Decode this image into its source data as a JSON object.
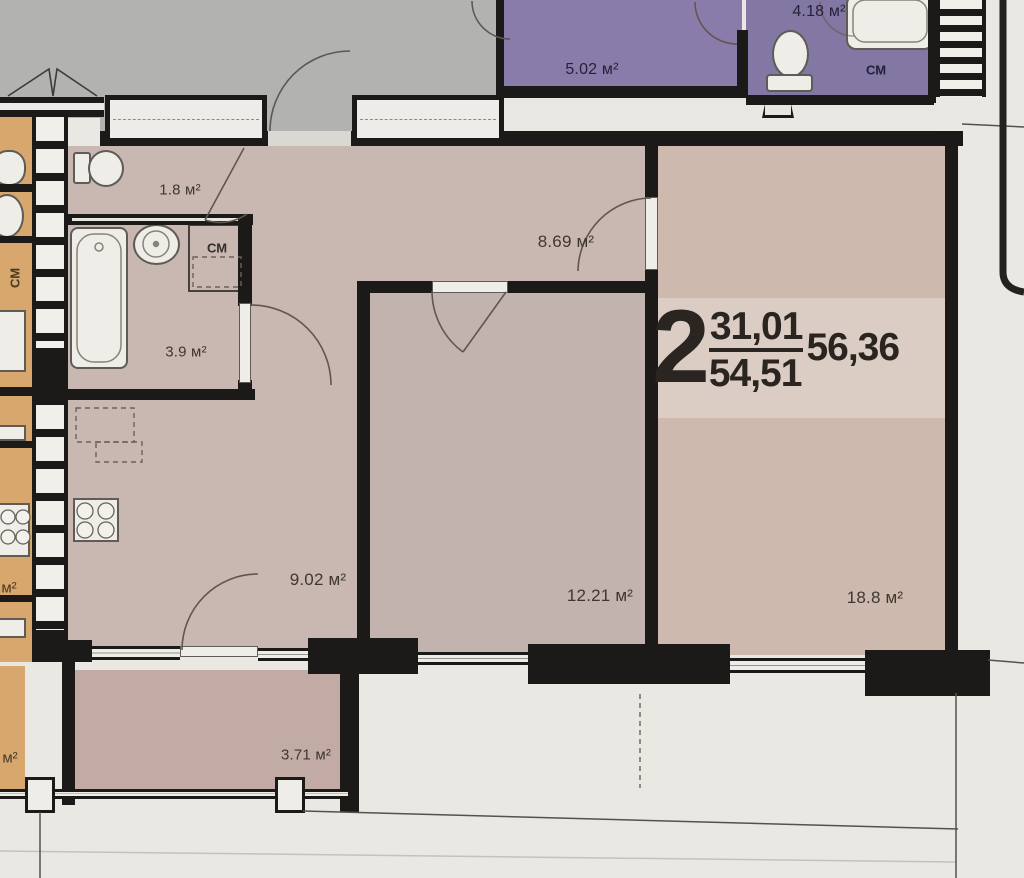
{
  "title": "Apartment floor plan — 2-room flat",
  "stamp": {
    "rooms_count": "2",
    "living_area": "31,01",
    "total_area": "54,51",
    "overall_area": "56,36"
  },
  "rooms": {
    "r502": {
      "label": "5.02 м²"
    },
    "r418": {
      "label": "4.18 м²"
    },
    "top_washer": {
      "label": "СМ"
    },
    "r18": {
      "label": "1.8 м²"
    },
    "washer": {
      "label": "СМ"
    },
    "r39": {
      "label": "3.9 м²"
    },
    "hallway": {
      "label": "8.69 м²"
    },
    "kitchen": {
      "label": "9.02 м²"
    },
    "bedroom": {
      "label": "12.21 м²"
    },
    "living": {
      "label": "18.8 м²"
    },
    "balcony": {
      "label": "3.71 м²"
    },
    "neighbor_washer": {
      "label": "СМ"
    },
    "neighbor_area_1": {
      "label": "м²"
    },
    "neighbor_area_2": {
      "label": "м²"
    }
  },
  "colors": {
    "background": "#e9e8e3",
    "gray": "#b2b2b0",
    "corridor": "#e8e7e2",
    "purple": "#8a7caa",
    "purple_dark": "#8377a3",
    "pink": "#c9b8b2",
    "pink_bedroom": "#c3b3ae",
    "pink_living": "#cdb9ad",
    "pink_balcony": "#c2aba4",
    "orange": "#d7a76e",
    "wall": "#1b1a18",
    "fixture": "#efede8"
  }
}
